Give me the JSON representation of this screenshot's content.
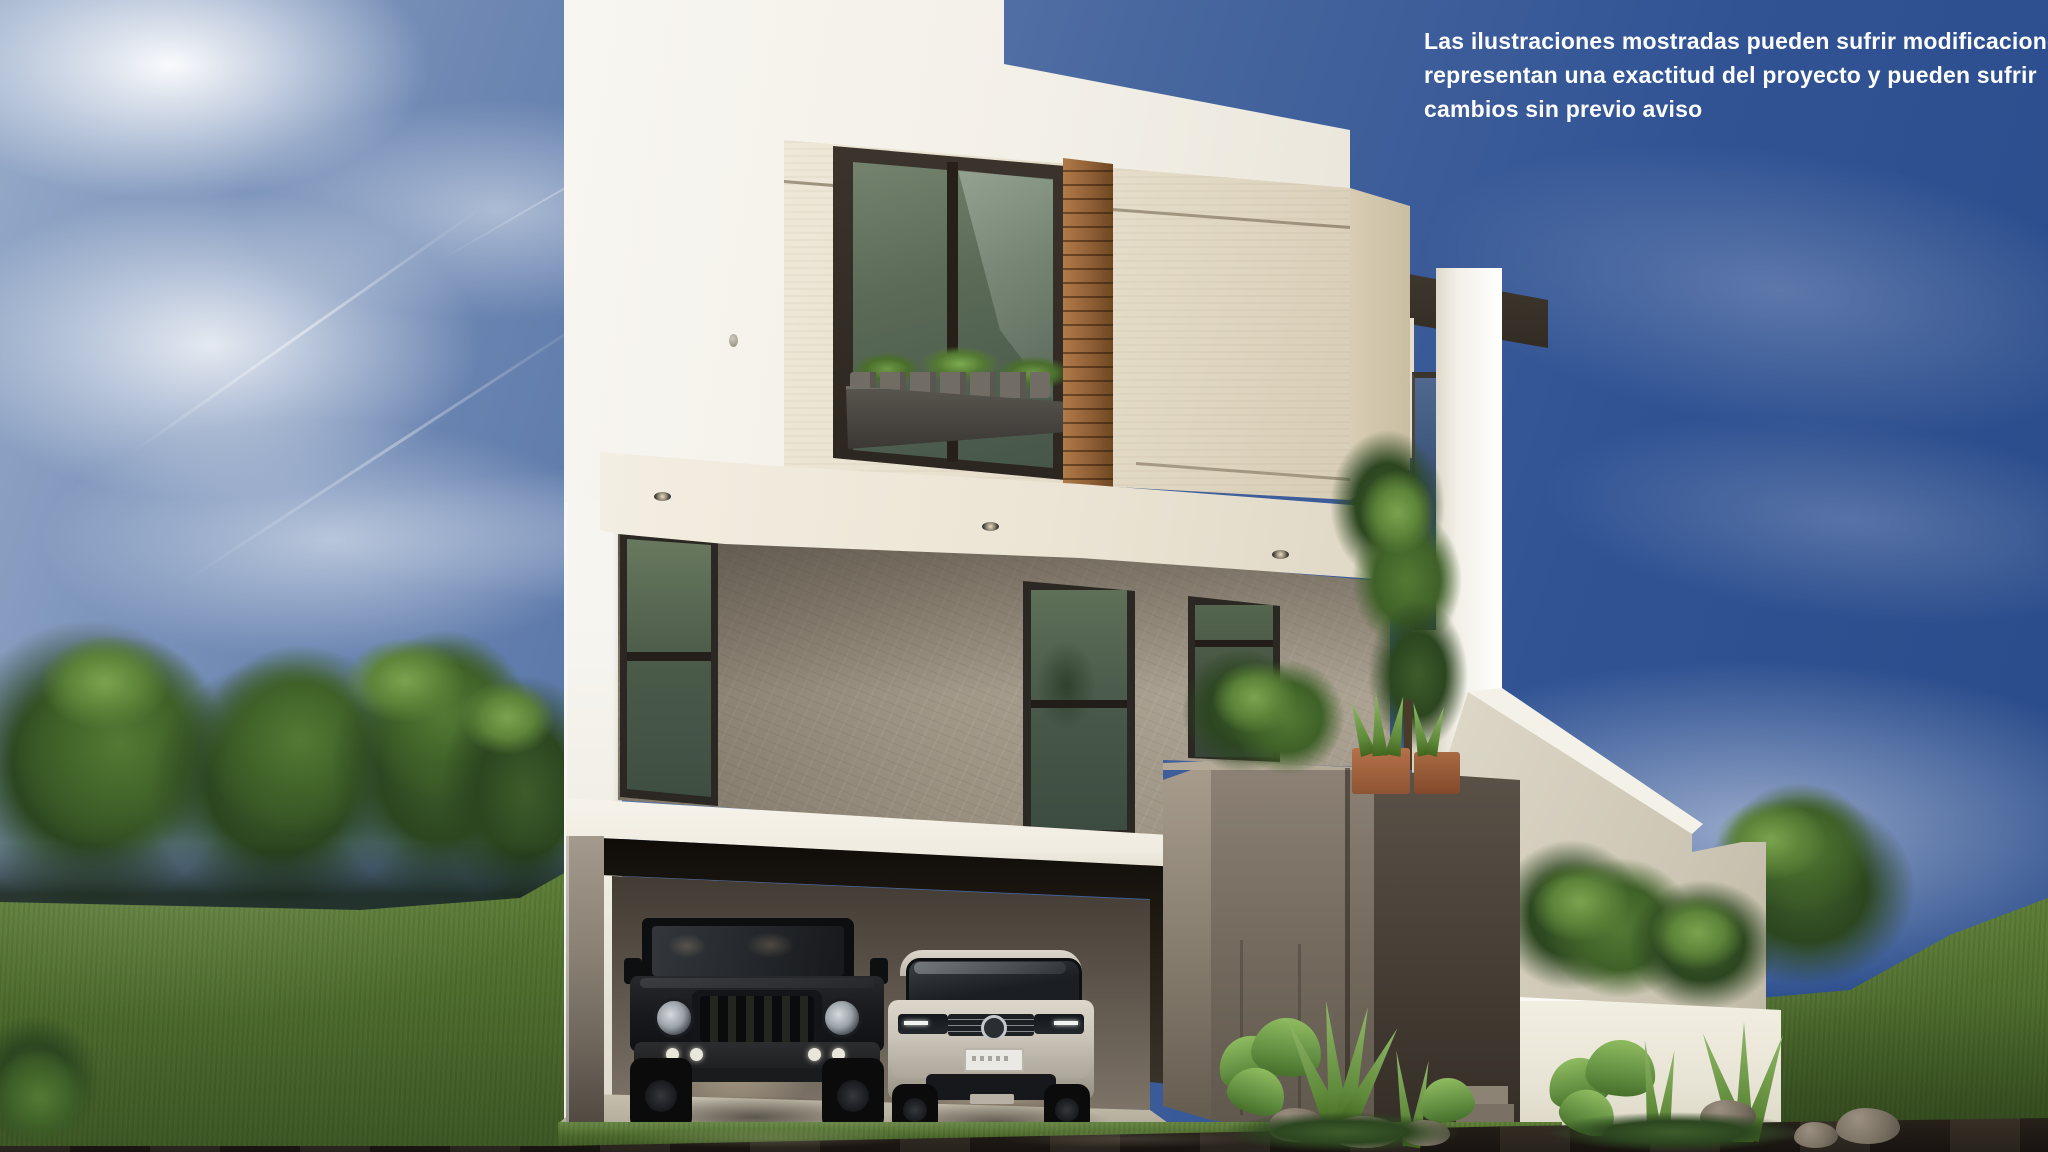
{
  "disclaimer": {
    "text": "Las ilustraciones mostradas pueden sufrir modificaciones no\nrepresentan una exactitud del proyecto y pueden sufrir\ncambios sin previo aviso",
    "lines": [
      "Las ilustraciones mostradas pueden sufrir modificaciones no",
      "representan una exactitud del proyecto y pueden sufrir",
      "cambios sin previo aviso"
    ],
    "color": "#ffffff"
  },
  "scene": {
    "type": "architectural-exterior-render",
    "subject": "modern three-level residence with open two-car garage",
    "time_of_day": "day",
    "elements": [
      "blue-sky-with-clouds",
      "contrails",
      "tree-line-left",
      "grass-hill-left",
      "grass-hill-right",
      "round-tree-right",
      "white-stucco-volume",
      "cream-stucco-volume",
      "upper-window-with-planter",
      "wood-slat-accent-panel",
      "stone-clad-middle-floor",
      "green-glass-windows",
      "recessed-soffit-lights",
      "white-floor-slab",
      "dark-garage-header",
      "open-garage",
      "black-offroad-suv",
      "white-crossover-suv",
      "taupe-entry-volumes",
      "terracotta-planters",
      "roof-top-plants",
      "white-portal-frame",
      "descending-stair-parapet",
      "white-garden-wall",
      "shrubs",
      "agave-and-tropical-plants",
      "rocks",
      "concrete-driveway",
      "wet-asphalt-street"
    ]
  },
  "vehicles": {
    "left": "black off-road SUV parked in garage",
    "right": "white crossover SUV parked in garage"
  },
  "palette": {
    "sky_deep": "#2a4b89",
    "sky_light": "#93a8c8",
    "cloud": "#ffffff",
    "white_wall": "#f5f3ec",
    "cream_wall": "#e7dfcc",
    "stone": "#a19787",
    "glass_green": "#55654f",
    "wood_slat": "#8a5a32",
    "garage_dark": "#3f3831",
    "taupe_volume": "#756b5f",
    "stair_beige": "#d6d0c1",
    "garden_wall": "#efece0",
    "grass": "#4e6c2e",
    "tree_dark": "#2c4620",
    "tree_light": "#5d8439",
    "asphalt": "#1f1a14",
    "concrete": "#b3ab9b",
    "jeep_black": "#141619",
    "suv_silver": "#ccc6bc"
  }
}
